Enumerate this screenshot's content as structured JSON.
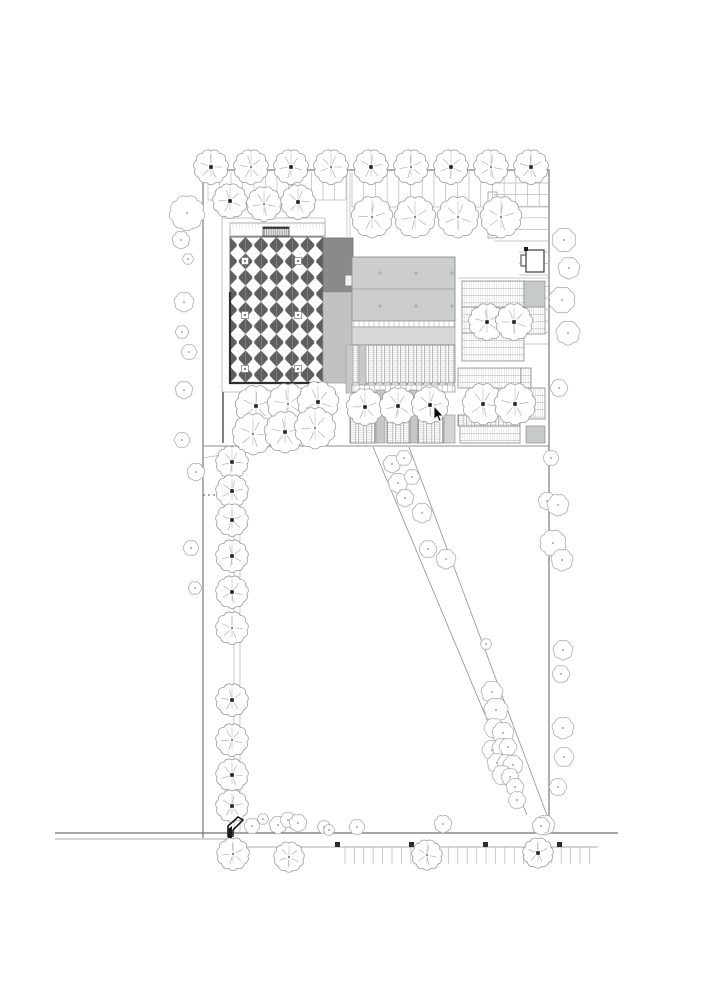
{
  "meta": {
    "type": "architectural-site-plan",
    "view": "site plan with buildings, parking, field and tree planting",
    "paper_color": "#ffffff"
  },
  "colors": {
    "paper": "#ffffff",
    "line_faint": "#cfcfcf",
    "line_light": "#b9b9b9",
    "line_mid": "#8f8f8f",
    "line_strong": "#6f6f6f",
    "outline_dark": "#3a3a3a",
    "outline_heavy": "#2e2e2e",
    "coffer_dark": "#5f5f5f",
    "gray_dark": "#8a8a8a",
    "gray_mid": "#c2c2c2",
    "gray_roof": "#cccece",
    "gray_apron": "#d7d7d7",
    "gray_tile": "#c6caca",
    "tree_stroke": "#9c9c9c",
    "cursor": "#0a0a0a"
  },
  "site": {
    "boundary": "M203,838 L203,170 L549,170 L549,827",
    "division_line": [
      203,
      446,
      549,
      446
    ],
    "guide_lines": [
      [
        352,
        207,
        549,
        207
      ],
      [
        208,
        200,
        346,
        200
      ],
      [
        458,
        278,
        549,
        278
      ],
      [
        203,
        458,
        336,
        436
      ],
      [
        228,
        390,
        332,
        390
      ]
    ]
  },
  "parking": {
    "tick_groups": [
      {
        "o": "v",
        "x0": 208,
        "x1": 346,
        "step": 11.5,
        "y0": 172,
        "y1": 200
      },
      {
        "o": "v",
        "x0": 352,
        "x1": 544,
        "step": 11.7,
        "y0": 172,
        "y1": 207
      },
      {
        "o": "h",
        "y0": 183,
        "y1": 241,
        "step": 11.6,
        "x0": 494,
        "x1": 548
      },
      {
        "o": "h",
        "y0": 252,
        "y1": 344,
        "step": 11.5,
        "x0": 519,
        "x1": 548
      },
      {
        "o": "v",
        "x0": 345,
        "x1": 598,
        "step": 9.4,
        "y0": 847,
        "y1": 864
      }
    ],
    "drive_lines": [
      [
        347,
        172,
        347,
        237
      ],
      [
        350,
        172,
        350,
        237
      ]
    ],
    "stall_divider_rect": [
      488,
      192,
      9,
      46
    ],
    "marker_squares": [
      [
        335,
        842
      ],
      [
        409,
        842
      ],
      [
        483,
        842
      ],
      [
        557,
        842
      ]
    ]
  },
  "road": {
    "lines": [
      [
        55,
        833,
        618,
        833
      ],
      [
        55,
        839,
        237,
        839
      ],
      [
        240,
        847,
        598,
        847
      ]
    ]
  },
  "walkway": {
    "lines": [
      [
        234,
        450,
        234,
        833
      ],
      [
        240,
        450,
        240,
        833
      ]
    ],
    "wall_line": [
      223,
      296,
      223,
      443
    ],
    "dots": [
      [
        204,
        495
      ],
      [
        209,
        495
      ],
      [
        214,
        495
      ]
    ]
  },
  "path": {
    "edges": [
      [
        373,
        447,
        527,
        815
      ],
      [
        409,
        447,
        548,
        818
      ]
    ]
  },
  "buildings": {
    "main_hall": {
      "terrace": [
        222,
        218,
        103,
        174
      ],
      "canopy": [
        230,
        223,
        95,
        13
      ],
      "entrance": [
        263,
        227,
        26,
        9
      ],
      "roof": [
        230,
        237,
        93,
        146
      ],
      "rosettes": [
        [
          245,
          261
        ],
        [
          298,
          261
        ],
        [
          245,
          315
        ],
        [
          298,
          315
        ],
        [
          245,
          369
        ],
        [
          298,
          369
        ]
      ]
    },
    "connector": {
      "upper": [
        323,
        238,
        30,
        54
      ],
      "lower": [
        323,
        292,
        30,
        91
      ],
      "skylights": [
        [
          345,
          275,
          11,
          11
        ],
        [
          357,
          327,
          12,
          12
        ]
      ]
    },
    "hall_b": {
      "roof": [
        352,
        257,
        103,
        64
      ],
      "ridge_y": 289,
      "vent_marks": [
        [
          380,
          273
        ],
        [
          416,
          273
        ],
        [
          452,
          273
        ],
        [
          380,
          306
        ],
        [
          416,
          306
        ],
        [
          452,
          306
        ]
      ],
      "seam": [
        352,
        321,
        103,
        6
      ],
      "apron": [
        352,
        327,
        103,
        18
      ],
      "louver_roof": [
        352,
        345,
        103,
        38
      ],
      "caps_y": 383,
      "legs": [
        [
          346,
          345,
          7,
          48
        ],
        [
          359,
          345,
          7,
          48
        ]
      ]
    },
    "bays": {
      "caps_row": [
        352,
        385,
        103,
        7
      ],
      "mullions": [
        [
          376,
          390,
          9,
          53
        ],
        [
          409,
          390,
          9,
          53
        ]
      ],
      "louver_panels": [
        [
          350,
          415,
          25,
          28
        ],
        [
          387,
          414,
          23,
          29
        ],
        [
          418,
          413,
          25,
          30
        ]
      ],
      "end_panel": [
        444,
        415,
        11,
        28
      ]
    },
    "pergolas": {
      "deck_rects": [
        [
          462,
          281,
          62,
          26
        ],
        [
          462,
          307,
          16,
          26
        ],
        [
          462,
          333,
          62,
          28
        ],
        [
          522,
          307,
          23,
          27
        ],
        [
          458,
          368,
          64,
          20
        ],
        [
          460,
          426,
          60,
          17
        ],
        [
          524,
          388,
          21,
          31
        ],
        [
          521,
          368,
          10,
          20
        ]
      ],
      "louver_rects": [
        [
          458,
          415,
          62,
          11
        ]
      ],
      "gray_tiles": [
        [
          524,
          281,
          21,
          26
        ],
        [
          526,
          426,
          19,
          17
        ]
      ]
    },
    "guard_house": {
      "body": [
        526,
        250,
        18,
        22
      ],
      "notch": [
        521,
        255,
        7,
        11
      ],
      "marker": [
        524,
        247,
        4,
        4
      ]
    }
  },
  "landscape": {
    "trees": [
      [
        211,
        167,
        16,
        1
      ],
      [
        251,
        167,
        16,
        0
      ],
      [
        291,
        167,
        16,
        1
      ],
      [
        331,
        167,
        16,
        0
      ],
      [
        371,
        167,
        16,
        1
      ],
      [
        411,
        167,
        16,
        0
      ],
      [
        451,
        167,
        16,
        1
      ],
      [
        491,
        167,
        16,
        0
      ],
      [
        531,
        167,
        16,
        1
      ],
      [
        230,
        201,
        16,
        1
      ],
      [
        264,
        204,
        16,
        0
      ],
      [
        298,
        202,
        16,
        1
      ],
      [
        372,
        217,
        19,
        0
      ],
      [
        415,
        217,
        19,
        0
      ],
      [
        458,
        217,
        19,
        0
      ],
      [
        501,
        217,
        19,
        0
      ],
      [
        487,
        322,
        17,
        1
      ],
      [
        514,
        322,
        17,
        1
      ],
      [
        483,
        404,
        19,
        1
      ],
      [
        515,
        404,
        19,
        1
      ],
      [
        365,
        407,
        17,
        1
      ],
      [
        398,
        406,
        17,
        1
      ],
      [
        430,
        405,
        17,
        1
      ],
      [
        256,
        406,
        19,
        1
      ],
      [
        288,
        404,
        19,
        0
      ],
      [
        318,
        402,
        19,
        1
      ],
      [
        253,
        434,
        19,
        0
      ],
      [
        285,
        432,
        19,
        1
      ],
      [
        315,
        428,
        19,
        0
      ],
      [
        232,
        462,
        15,
        1
      ],
      [
        232,
        491,
        15,
        1
      ],
      [
        232,
        520,
        15,
        1
      ],
      [
        232,
        556,
        15,
        1
      ],
      [
        232,
        592,
        15,
        1
      ],
      [
        232,
        628,
        15,
        0
      ],
      [
        232,
        700,
        15,
        1
      ],
      [
        232,
        740,
        15,
        0
      ],
      [
        232,
        775,
        15,
        1
      ],
      [
        232,
        806,
        15,
        1
      ],
      [
        233,
        854,
        15,
        0
      ],
      [
        289,
        857,
        14,
        0
      ],
      [
        427,
        855,
        14,
        0
      ],
      [
        538,
        853,
        14,
        1
      ]
    ],
    "clouds": [
      [
        187,
        213,
        16,
        9
      ],
      [
        181,
        240,
        8,
        7
      ],
      [
        188,
        259,
        5,
        6
      ],
      [
        184,
        302,
        9,
        7
      ],
      [
        182,
        332,
        6,
        6
      ],
      [
        189,
        352,
        7,
        6
      ],
      [
        184,
        390,
        8,
        7
      ],
      [
        182,
        440,
        7,
        6
      ],
      [
        196,
        472,
        8,
        7
      ],
      [
        191,
        548,
        7,
        6
      ],
      [
        195,
        588,
        6,
        6
      ],
      [
        564,
        240,
        11,
        8
      ],
      [
        569,
        268,
        10,
        7
      ],
      [
        562,
        300,
        12,
        8
      ],
      [
        568,
        333,
        11,
        7
      ],
      [
        559,
        388,
        8,
        6
      ],
      [
        551,
        458,
        7,
        6
      ],
      [
        547,
        501,
        8,
        7
      ],
      [
        558,
        505,
        10,
        7
      ],
      [
        553,
        543,
        12,
        8
      ],
      [
        562,
        560,
        10,
        7
      ],
      [
        563,
        650,
        9,
        7
      ],
      [
        561,
        674,
        8,
        6
      ],
      [
        563,
        728,
        10,
        7
      ],
      [
        564,
        757,
        9,
        6
      ],
      [
        558,
        787,
        8,
        6
      ],
      [
        545,
        825,
        9,
        7
      ],
      [
        392,
        464,
        8,
        7
      ],
      [
        404,
        458,
        7,
        6
      ],
      [
        398,
        483,
        9,
        7
      ],
      [
        412,
        477,
        7,
        6
      ],
      [
        405,
        498,
        8,
        7
      ],
      [
        422,
        513,
        9,
        7
      ],
      [
        428,
        549,
        8,
        6
      ],
      [
        446,
        559,
        9,
        7
      ],
      [
        486,
        644,
        5,
        6
      ],
      [
        492,
        692,
        10,
        7
      ],
      [
        496,
        710,
        11,
        7
      ],
      [
        494,
        728,
        9,
        6
      ],
      [
        503,
        733,
        10,
        7
      ],
      [
        492,
        750,
        9,
        6
      ],
      [
        502,
        748,
        9,
        7
      ],
      [
        508,
        747,
        8,
        6
      ],
      [
        497,
        763,
        9,
        7
      ],
      [
        506,
        763,
        8,
        6
      ],
      [
        513,
        765,
        9,
        7
      ],
      [
        502,
        775,
        9,
        6
      ],
      [
        510,
        777,
        8,
        6
      ],
      [
        515,
        787,
        8,
        7
      ],
      [
        517,
        800,
        8,
        6
      ],
      [
        278,
        825,
        8,
        7
      ],
      [
        288,
        820,
        7,
        6
      ],
      [
        298,
        823,
        8,
        7
      ],
      [
        324,
        827,
        6,
        6
      ],
      [
        329,
        830,
        5,
        6
      ],
      [
        357,
        827,
        7,
        6
      ],
      [
        443,
        824,
        8,
        7
      ],
      [
        541,
        826,
        8,
        7
      ],
      [
        252,
        826,
        7,
        6
      ],
      [
        263,
        819,
        5,
        6
      ]
    ]
  },
  "gate": {
    "outline": "228,837 228,826 238,817 243,820 233,830 233,837",
    "solid": "228,829 232,826 232,838 228,838"
  },
  "cursor": {
    "x": 434,
    "y": 406
  }
}
